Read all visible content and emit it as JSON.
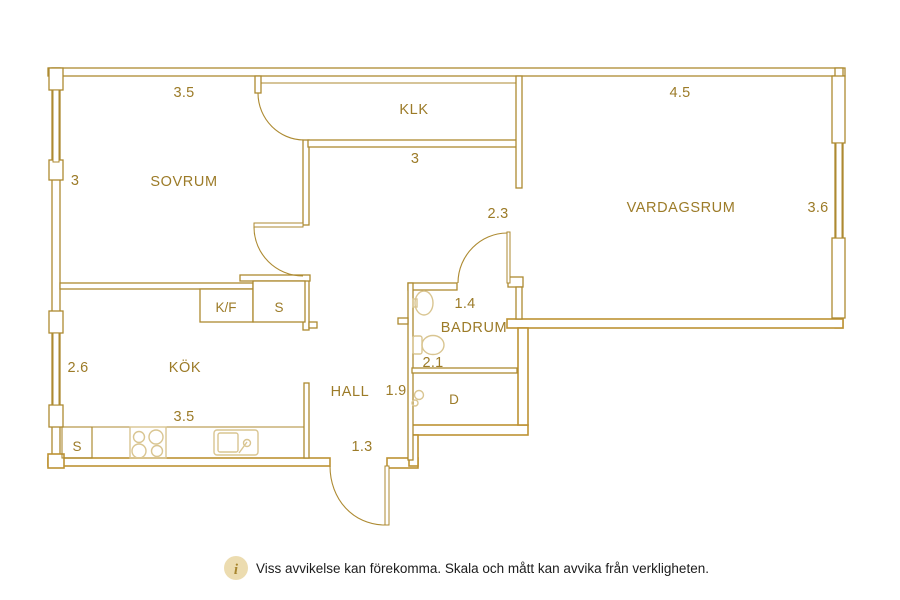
{
  "plan": {
    "rooms": {
      "sovrum": "SOVRUM",
      "klk": "KLK",
      "vardagsrum": "VARDAGSRUM",
      "kok": "KÖK",
      "hall": "HALL",
      "badrum": "BADRUM"
    },
    "measurements": {
      "sovrum_width": "3.5",
      "sovrum_depth": "3",
      "klk_width": "3",
      "vardagsrum_width": "4.5",
      "vardagsrum_depth": "3.6",
      "hall_upper_width": "2.3",
      "badrum_width": "1.4",
      "badrum_depth": "2.1",
      "hall_depth": "1.9",
      "hall_width": "1.3",
      "kok_depth": "2.6",
      "kok_width": "3.5"
    },
    "cabinets": {
      "fridge_freezer": "K/F",
      "bedroom_closet": "S",
      "kitchen_closet": "S",
      "shower": "D"
    },
    "colors": {
      "wall_line": "#ad8a31",
      "wall_thick_line": "#bd9233",
      "label_text": "#9c7b28",
      "fixture_line": "#d9c591",
      "footer_text": "#1c1c1c",
      "info_icon_bg": "#ecdcb0",
      "info_icon_fg": "#a8862f"
    },
    "footer": {
      "icon_letter": "i",
      "disclaimer": "Viss avvikelse kan förekomma. Skala och mått kan avvika från verkligheten."
    }
  }
}
